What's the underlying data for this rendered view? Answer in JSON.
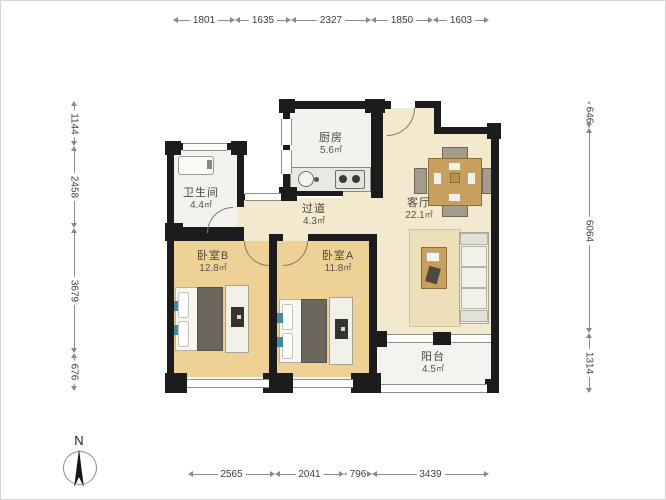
{
  "north_label": "N",
  "area_unit": "㎡",
  "rooms": {
    "bathroom": {
      "name": "卫生间",
      "area": "4.4"
    },
    "kitchen": {
      "name": "厨房",
      "area": "5.6"
    },
    "hallway": {
      "name": "过道",
      "area": "4.3"
    },
    "living": {
      "name": "客厅",
      "area": "22.1"
    },
    "bedroom_b": {
      "name": "卧室B",
      "area": "12.8"
    },
    "bedroom_a": {
      "name": "卧室A",
      "area": "11.8"
    },
    "balcony": {
      "name": "阳台",
      "area": "4.5"
    }
  },
  "dimensions_mm": {
    "top": [
      "1801",
      "1635",
      "2327",
      "1850",
      "1603"
    ],
    "bottom": [
      "2565",
      "2041",
      "796",
      "3439"
    ],
    "left": [
      "1144",
      "2458",
      "3679",
      "676"
    ],
    "right": [
      "646",
      "6064",
      "1314"
    ]
  },
  "colors": {
    "wall": "#1c1c1c",
    "floor_living": "#f2e9cf",
    "floor_bedroom": "#eed295",
    "floor_wet": "#f3f2ee",
    "wood": "#c99f5e"
  }
}
